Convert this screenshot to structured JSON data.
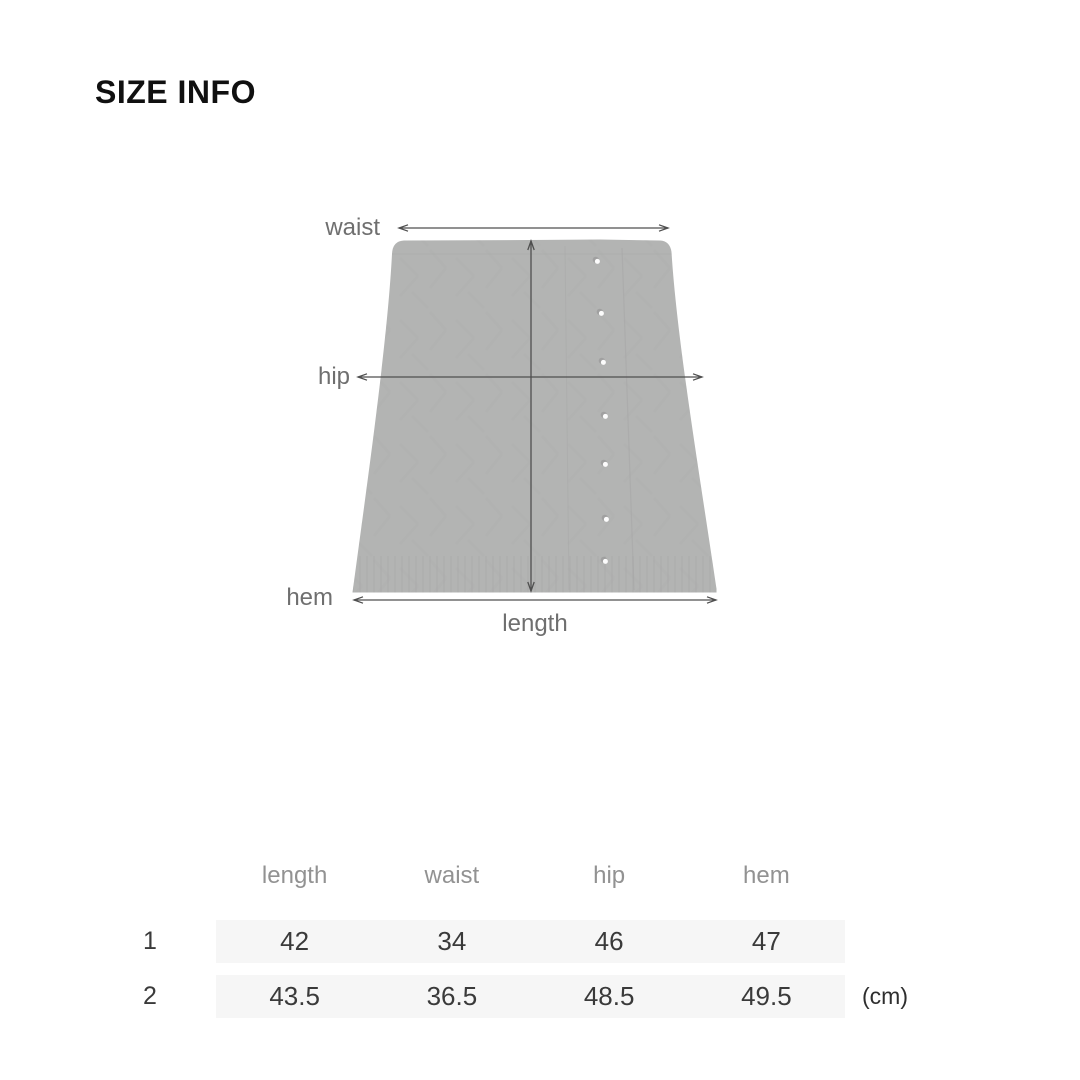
{
  "page": {
    "title": "SIZE INFO",
    "background": "#ffffff"
  },
  "diagram": {
    "labels": {
      "waist": "waist",
      "hip": "hip",
      "hem": "hem",
      "length": "length"
    },
    "button_count": 7,
    "colors": {
      "garment_fill": "#b3b4b3",
      "measure_line": "#4f4f4f",
      "label_text": "#6f6f6f",
      "button_fill": "#fcfcfc"
    }
  },
  "size_table": {
    "columns": [
      "length",
      "waist",
      "hip",
      "hem"
    ],
    "rows": [
      {
        "label": "1",
        "values": [
          "42",
          "34",
          "46",
          "47"
        ]
      },
      {
        "label": "2",
        "values": [
          "43.5",
          "36.5",
          "48.5",
          "49.5"
        ]
      }
    ],
    "unit_label": "(cm)",
    "colors": {
      "row_background": "#f6f6f6",
      "header_text": "#929292",
      "value_text": "#3a3a3a"
    }
  }
}
